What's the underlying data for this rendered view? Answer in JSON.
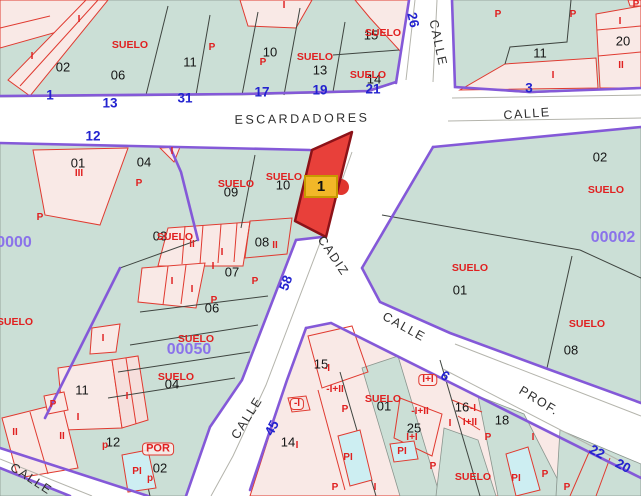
{
  "map": {
    "marker": {
      "label": "1"
    },
    "colors": {
      "block_green": "#cbdfd6",
      "parcel_pink": "#f9e9e6",
      "pool_cyan": "#cdeef2",
      "line_black": "#3f4540",
      "line_red": "#e03a30",
      "line_purple": "#8459d8",
      "line_gray": "#b4b4ac",
      "highlight_red": "#e8403a",
      "highlight_border": "#8c1218",
      "marker_yellow": "#f2b728",
      "marker_border": "#c79a00",
      "text_blue": "#2323cf",
      "text_purple": "#8a72ea",
      "text_red": "#e02020",
      "text_black": "#151515",
      "street_text": "#2e2e2e"
    },
    "label_groups": [
      {
        "name": "street-name",
        "cls": "st",
        "items": [
          {
            "t": "ESCARDADORES",
            "x": 302,
            "y": 119,
            "r": -1,
            "ls": 2.5
          },
          {
            "t": "CALLE",
            "x": 527,
            "y": 114,
            "r": -4
          },
          {
            "t": "CALLE",
            "x": 438,
            "y": 43,
            "r": 78
          },
          {
            "t": "CADIZ",
            "x": 333,
            "y": 256,
            "r": 56
          },
          {
            "t": "CALLE",
            "x": 247,
            "y": 418,
            "r": -58
          },
          {
            "t": "CALLE",
            "x": 404,
            "y": 327,
            "r": 29
          },
          {
            "t": "PROF.",
            "x": 539,
            "y": 401,
            "r": 31
          },
          {
            "t": "CALLE",
            "x": 31,
            "y": 479,
            "r": 33
          }
        ]
      },
      {
        "name": "house-number",
        "cls": "bn",
        "items": [
          {
            "t": "1",
            "x": 50,
            "y": 95
          },
          {
            "t": "13",
            "x": 110,
            "y": 103
          },
          {
            "t": "31",
            "x": 185,
            "y": 98
          },
          {
            "t": "12",
            "x": 93,
            "y": 136
          },
          {
            "t": "17",
            "x": 262,
            "y": 92
          },
          {
            "t": "19",
            "x": 320,
            "y": 90
          },
          {
            "t": "21",
            "x": 373,
            "y": 89
          },
          {
            "t": "26",
            "x": 413,
            "y": 20,
            "r": 78
          },
          {
            "t": "3",
            "x": 529,
            "y": 88
          },
          {
            "t": "58",
            "x": 286,
            "y": 283,
            "r": -70
          },
          {
            "t": "45",
            "x": 272,
            "y": 428,
            "r": -62
          },
          {
            "t": "6",
            "x": 445,
            "y": 376,
            "r": 35
          },
          {
            "t": "22",
            "x": 597,
            "y": 452,
            "r": 28
          },
          {
            "t": "20",
            "x": 623,
            "y": 466,
            "r": 28
          }
        ]
      },
      {
        "name": "zone-id",
        "cls": "pid",
        "items": [
          {
            "t": "0000",
            "x": 14,
            "y": 243
          },
          {
            "t": "00050",
            "x": 189,
            "y": 350
          },
          {
            "t": "00002",
            "x": 613,
            "y": 238
          }
        ]
      },
      {
        "name": "parcel-number",
        "cls": "pn",
        "items": [
          {
            "t": "02",
            "x": 63,
            "y": 67
          },
          {
            "t": "06",
            "x": 118,
            "y": 75
          },
          {
            "t": "11",
            "x": 190,
            "y": 62
          },
          {
            "t": "10",
            "x": 270,
            "y": 52
          },
          {
            "t": "13",
            "x": 320,
            "y": 70
          },
          {
            "t": "15",
            "x": 371,
            "y": 35
          },
          {
            "t": "14",
            "x": 374,
            "y": 79
          },
          {
            "t": "11",
            "x": 540,
            "y": 53
          },
          {
            "t": "20",
            "x": 623,
            "y": 41
          },
          {
            "t": "01",
            "x": 78,
            "y": 163
          },
          {
            "t": "04",
            "x": 144,
            "y": 162
          },
          {
            "t": "09",
            "x": 231,
            "y": 192
          },
          {
            "t": "10",
            "x": 283,
            "y": 185
          },
          {
            "t": "03",
            "x": 160,
            "y": 236
          },
          {
            "t": "08",
            "x": 262,
            "y": 242
          },
          {
            "t": "07",
            "x": 232,
            "y": 272
          },
          {
            "t": "06",
            "x": 212,
            "y": 308
          },
          {
            "t": "04",
            "x": 172,
            "y": 384
          },
          {
            "t": "11",
            "x": 82,
            "y": 390
          },
          {
            "t": "12",
            "x": 113,
            "y": 442
          },
          {
            "t": "02",
            "x": 160,
            "y": 468
          },
          {
            "t": "02",
            "x": 600,
            "y": 157
          },
          {
            "t": "01",
            "x": 460,
            "y": 290
          },
          {
            "t": "08",
            "x": 571,
            "y": 350
          },
          {
            "t": "15",
            "x": 321,
            "y": 364
          },
          {
            "t": "01",
            "x": 384,
            "y": 406
          },
          {
            "t": "25",
            "x": 414,
            "y": 428
          },
          {
            "t": "16",
            "x": 462,
            "y": 407
          },
          {
            "t": "18",
            "x": 502,
            "y": 420
          },
          {
            "t": "14",
            "x": 288,
            "y": 442
          }
        ]
      },
      {
        "name": "suelo-label",
        "cls": "rs",
        "items": [
          {
            "t": "SUELO",
            "x": 130,
            "y": 45
          },
          {
            "t": "SUELO",
            "x": 315,
            "y": 57
          },
          {
            "t": "SUELO",
            "x": 383,
            "y": 33
          },
          {
            "t": "SUELO",
            "x": 368,
            "y": 75
          },
          {
            "t": "SUELO",
            "x": 236,
            "y": 184
          },
          {
            "t": "SUELO",
            "x": 284,
            "y": 177
          },
          {
            "t": "SUELO",
            "x": 175,
            "y": 237
          },
          {
            "t": "SUELO",
            "x": 15,
            "y": 322
          },
          {
            "t": "SUELO",
            "x": 196,
            "y": 339
          },
          {
            "t": "SUELO",
            "x": 176,
            "y": 377
          },
          {
            "t": "SUELO",
            "x": 606,
            "y": 190
          },
          {
            "t": "SUELO",
            "x": 470,
            "y": 268
          },
          {
            "t": "SUELO",
            "x": 587,
            "y": 324
          },
          {
            "t": "SUELO",
            "x": 383,
            "y": 399
          },
          {
            "t": "SUELO",
            "x": 473,
            "y": 477
          }
        ]
      },
      {
        "name": "construction-label",
        "cls": "rl",
        "items": [
          {
            "t": "I",
            "x": 79,
            "y": 20
          },
          {
            "t": "I",
            "x": 32,
            "y": 57
          },
          {
            "t": "I",
            "x": 284,
            "y": 6
          },
          {
            "t": "P",
            "x": 212,
            "y": 48
          },
          {
            "t": "P",
            "x": 263,
            "y": 63
          },
          {
            "t": "P",
            "x": 498,
            "y": 15
          },
          {
            "t": "P",
            "x": 573,
            "y": 15
          },
          {
            "t": "P",
            "x": 636,
            "y": 5
          },
          {
            "t": "I",
            "x": 620,
            "y": 22
          },
          {
            "t": "II",
            "x": 621,
            "y": 66
          },
          {
            "t": "I",
            "x": 553,
            "y": 76
          },
          {
            "t": "I",
            "x": 172,
            "y": 152
          },
          {
            "t": "III",
            "x": 79,
            "y": 174
          },
          {
            "t": "P",
            "x": 139,
            "y": 184
          },
          {
            "t": "P",
            "x": 40,
            "y": 218
          },
          {
            "t": "II",
            "x": 192,
            "y": 245
          },
          {
            "t": "I",
            "x": 222,
            "y": 253
          },
          {
            "t": "I",
            "x": 213,
            "y": 267
          },
          {
            "t": "II",
            "x": 275,
            "y": 246
          },
          {
            "t": "P",
            "x": 255,
            "y": 282
          },
          {
            "t": "I",
            "x": 172,
            "y": 282
          },
          {
            "t": "I",
            "x": 192,
            "y": 290
          },
          {
            "t": "P",
            "x": 214,
            "y": 301
          },
          {
            "t": "I",
            "x": 103,
            "y": 339
          },
          {
            "t": "I",
            "x": 127,
            "y": 397
          },
          {
            "t": "I",
            "x": 78,
            "y": 418
          },
          {
            "t": "II",
            "x": 15,
            "y": 433
          },
          {
            "t": "II",
            "x": 62,
            "y": 437
          },
          {
            "t": "P",
            "x": 53,
            "y": 405
          },
          {
            "t": "p",
            "x": 105,
            "y": 446
          },
          {
            "t": "POR",
            "x": 158,
            "y": 449,
            "box": true,
            "fs": 11
          },
          {
            "t": "PI",
            "x": 137,
            "y": 472
          },
          {
            "t": "p",
            "x": 150,
            "y": 479
          },
          {
            "t": "-I",
            "x": 327,
            "y": 369
          },
          {
            "t": "-I+II",
            "x": 335,
            "y": 390
          },
          {
            "t": "-I",
            "x": 297,
            "y": 404,
            "box": true
          },
          {
            "t": "P",
            "x": 345,
            "y": 410
          },
          {
            "t": "I",
            "x": 297,
            "y": 446
          },
          {
            "t": "PI",
            "x": 348,
            "y": 458
          },
          {
            "t": "P",
            "x": 335,
            "y": 488
          },
          {
            "t": "I",
            "x": 375,
            "y": 488
          },
          {
            "t": "-I+II",
            "x": 420,
            "y": 412
          },
          {
            "t": "I+I",
            "x": 412,
            "y": 438
          },
          {
            "t": "PI",
            "x": 402,
            "y": 452
          },
          {
            "t": "I+I",
            "x": 428,
            "y": 380,
            "box": true
          },
          {
            "t": "-I",
            "x": 473,
            "y": 409
          },
          {
            "t": "I+II",
            "x": 470,
            "y": 423
          },
          {
            "t": "I",
            "x": 450,
            "y": 424
          },
          {
            "t": "I",
            "x": 533,
            "y": 438
          },
          {
            "t": "P",
            "x": 433,
            "y": 467
          },
          {
            "t": "PI",
            "x": 516,
            "y": 479
          },
          {
            "t": "P",
            "x": 488,
            "y": 438
          },
          {
            "t": "P",
            "x": 545,
            "y": 475
          },
          {
            "t": "P",
            "x": 567,
            "y": 488
          }
        ]
      }
    ]
  }
}
